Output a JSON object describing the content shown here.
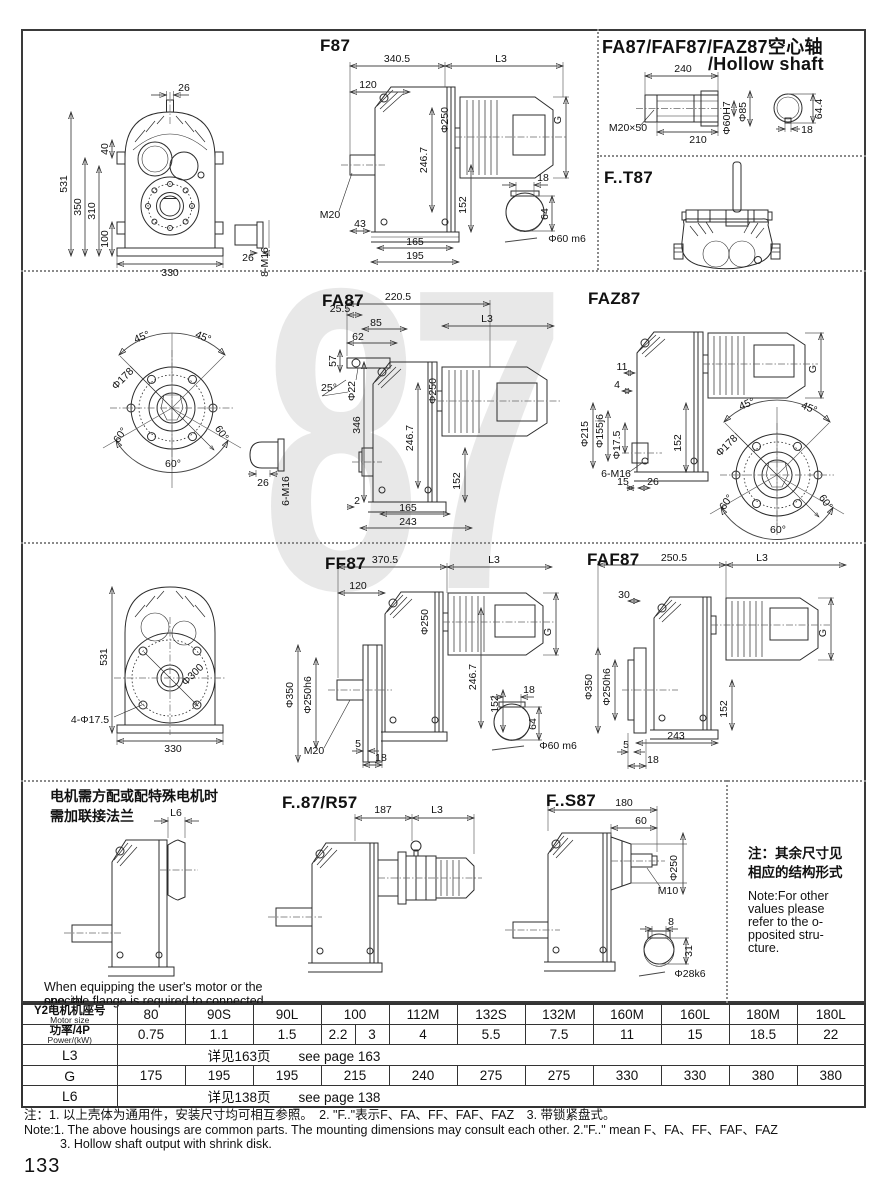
{
  "page": {
    "number": "133",
    "watermark": "87"
  },
  "sections": {
    "f87": {
      "title": "F87",
      "front": {
        "shaft_w": "26",
        "h_total": "531",
        "h1": "350",
        "h2": "310",
        "h3": "100",
        "h4": "40",
        "w": "330",
        "plug_w": "26",
        "plug_thread": "8-M16"
      },
      "side": {
        "w": "340.5",
        "l3": "L3",
        "front_w": "120",
        "motor_dia": "Φ250",
        "mid_h": "246.7",
        "g": "G",
        "out_h": "152",
        "thread": "M20",
        "shaft_len": "43",
        "foot1": "165",
        "foot2": "195"
      },
      "shaft": {
        "key_w": "18",
        "key_h": "64",
        "dia": "Φ60 m6"
      }
    },
    "hollow": {
      "title_zh": "FA87/FAF87/FAZ87空心轴",
      "title_en": "/Hollow shaft",
      "len": "240",
      "len2": "210",
      "thread": "M20×50",
      "bore": "Φ60H7",
      "outer": "Φ85",
      "key_h": "64.4",
      "key_w": "18"
    },
    "ft87": {
      "title": "F..T87"
    },
    "fa87": {
      "title": "FA87",
      "flange": {
        "a45l": "45°",
        "a45r": "45°",
        "dia": "Φ178",
        "a60l": "60°",
        "a60r": "60°",
        "a60b": "60°",
        "plug_w": "26",
        "plug_thread": "6-M16"
      },
      "side": {
        "w": "220.5",
        "off": "25.5",
        "d85": "85",
        "d62": "62",
        "d57": "57",
        "a25": "25°",
        "bolt": "Φ22",
        "h346": "346",
        "motor_dia": "Φ250",
        "mid_h": "246.7",
        "out_h": "152",
        "d2": "2",
        "foot1": "165",
        "foot2": "243",
        "l3": "L3"
      }
    },
    "faz87": {
      "title": "FAZ87",
      "side": {
        "d11": "11",
        "d4": "4",
        "dia215": "Φ215",
        "dia155": "Φ155j6",
        "dia175": "Φ17.5",
        "out_h": "152",
        "thread": "6-M16",
        "d15": "15",
        "d26": "26",
        "g": "G"
      },
      "flange": {
        "dia": "Φ178",
        "a45l": "45°",
        "a45r": "45°",
        "a60l": "60°",
        "a60r": "60°",
        "a60b": "60°"
      }
    },
    "ff87": {
      "title": "FF87",
      "front": {
        "h": "531",
        "dia": "Φ300",
        "holes": "4-Φ17.5",
        "w": "330"
      },
      "side": {
        "w": "370.5",
        "l3": "L3",
        "front_w": "120",
        "motor_dia": "Φ250",
        "mid_h": "246.7",
        "out_h": "152",
        "g": "G",
        "flange_dia": "Φ350",
        "spigot": "Φ250h6",
        "thread": "M20",
        "d5": "5",
        "d18": "18"
      },
      "shaft": {
        "key_w": "18",
        "key_h": "64",
        "dia": "Φ60 m6"
      }
    },
    "faf87": {
      "title": "FAF87",
      "side": {
        "w": "250.5",
        "l3": "L3",
        "d30": "30",
        "flange_dia": "Φ350",
        "spigot": "Φ250h6",
        "out_h": "152",
        "foot": "243",
        "d5": "5",
        "d18": "18",
        "g": "G"
      }
    },
    "flange_note": {
      "zh1": "电机需方配或配特殊电机时",
      "zh2": "需加联接法兰",
      "l6": "L6",
      "en1": "When equipping the user's motor or the special",
      "en2": "one, the flange is required to connected."
    },
    "f87r57": {
      "title": "F..87/R57",
      "d187": "187",
      "l3": "L3"
    },
    "fs87": {
      "title": "F..S87",
      "d180": "180",
      "d60": "60",
      "dia250": "Φ250",
      "thread": "M10",
      "key_w": "8",
      "key_h": "31",
      "dia": "Φ28k6"
    },
    "side_note": {
      "zh1": "注：其余尺寸见",
      "zh2": "相应的结构形式",
      "en1": "Note:For other",
      "en2": "values please",
      "en3": "refer to the o-",
      "en4": "pposited stru-",
      "en5": "cture."
    }
  },
  "table": {
    "motor_header_zh": "Y2电机机座号",
    "motor_header_en": "Motor size",
    "power_header_zh": "功率/4P",
    "power_header_en": "Power/(kW)",
    "l3_label": "L3",
    "g_label": "G",
    "l6_label": "L6",
    "motor_sizes": [
      "80",
      "90S",
      "90L",
      "100",
      "112M",
      "132S",
      "132M",
      "160M",
      "160L",
      "180M",
      "180L"
    ],
    "power_values": [
      "0.75",
      "1.1",
      "1.5",
      "2.2",
      "3",
      "4",
      "5.5",
      "7.5",
      "11",
      "15",
      "18.5",
      "22"
    ],
    "l3_zh": "详见163页",
    "l3_en": "see page 163",
    "g_values": [
      "175",
      "195",
      "195",
      "215",
      "240",
      "275",
      "275",
      "330",
      "330",
      "380",
      "380"
    ],
    "l6_zh": "详见138页",
    "l6_en": "see page 138"
  },
  "notes": {
    "zh": "注：1. 以上壳体为通用件，安装尺寸均可相互参照。　2. \"F..\"表示F、FA、FF、FAF、FAZ　3. 带锁紧盘式。",
    "en1": "Note:1. The above housings are common parts. The mounting dimensions may consult each other.  2.\"F..\" mean F、FA、FF、FAF、FAZ",
    "en2": "3. Hollow shaft output with shrink disk."
  }
}
